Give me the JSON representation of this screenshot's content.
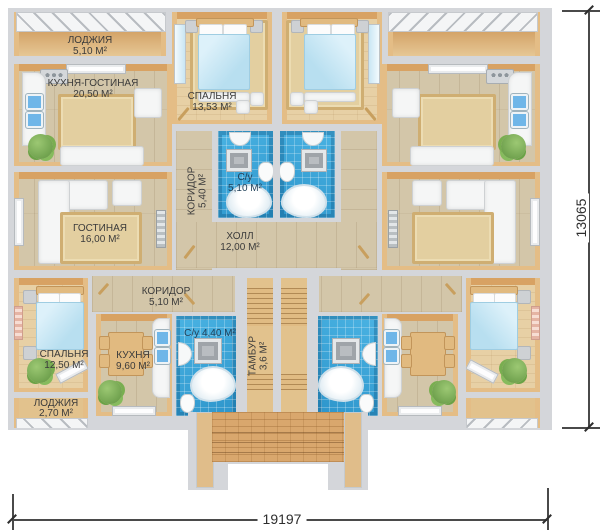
{
  "rooms": {
    "loggia_top": {
      "name": "ЛОДЖИЯ",
      "area": "5,10 М²"
    },
    "kitchen_living": {
      "name": "КУХНЯ-ГОСТИНАЯ",
      "area": "20,50 М²"
    },
    "bedroom_top": {
      "name": "СПАЛЬНЯ",
      "area": "13,53 М²"
    },
    "living_room": {
      "name": "ГОСТИНАЯ",
      "area": "16,00 М²"
    },
    "corridor_upper": {
      "name": "КОРИДОР",
      "area": "5,40 М²"
    },
    "bathroom_upper": {
      "name": "С/у",
      "area": "5,10 М²"
    },
    "hall": {
      "name": "ХОЛЛ",
      "area": "12,00 М²"
    },
    "corridor_lower": {
      "name": "КОРИДОР",
      "area": "5,10 М²"
    },
    "bedroom_lower": {
      "name": "СПАЛЬНЯ",
      "area": "12,50 М²"
    },
    "kitchen": {
      "name": "КУХНЯ",
      "area": "9,60 М²"
    },
    "bathroom_lower": {
      "name": "С/у",
      "area": "4,40 М²"
    },
    "tambour": {
      "name": "ТАМБУР",
      "area": "3,6 М²"
    },
    "loggia_bottom": {
      "name": "ЛОДЖИЯ",
      "area": "2,70 М²"
    }
  },
  "dimensions": {
    "width_mm": "19197",
    "height_mm": "13065"
  },
  "colors": {
    "wall_gray": "#d4d6da",
    "wall_accent_orange": "#d8a263",
    "wall_accent_tan": "#e4bd86",
    "bathroom_tile_blue": "#38a8dd",
    "floor_wood": "#d3c6a9",
    "brick_porch": "#d9a76d",
    "bed_blanket_blue": "#c9e7f5"
  }
}
